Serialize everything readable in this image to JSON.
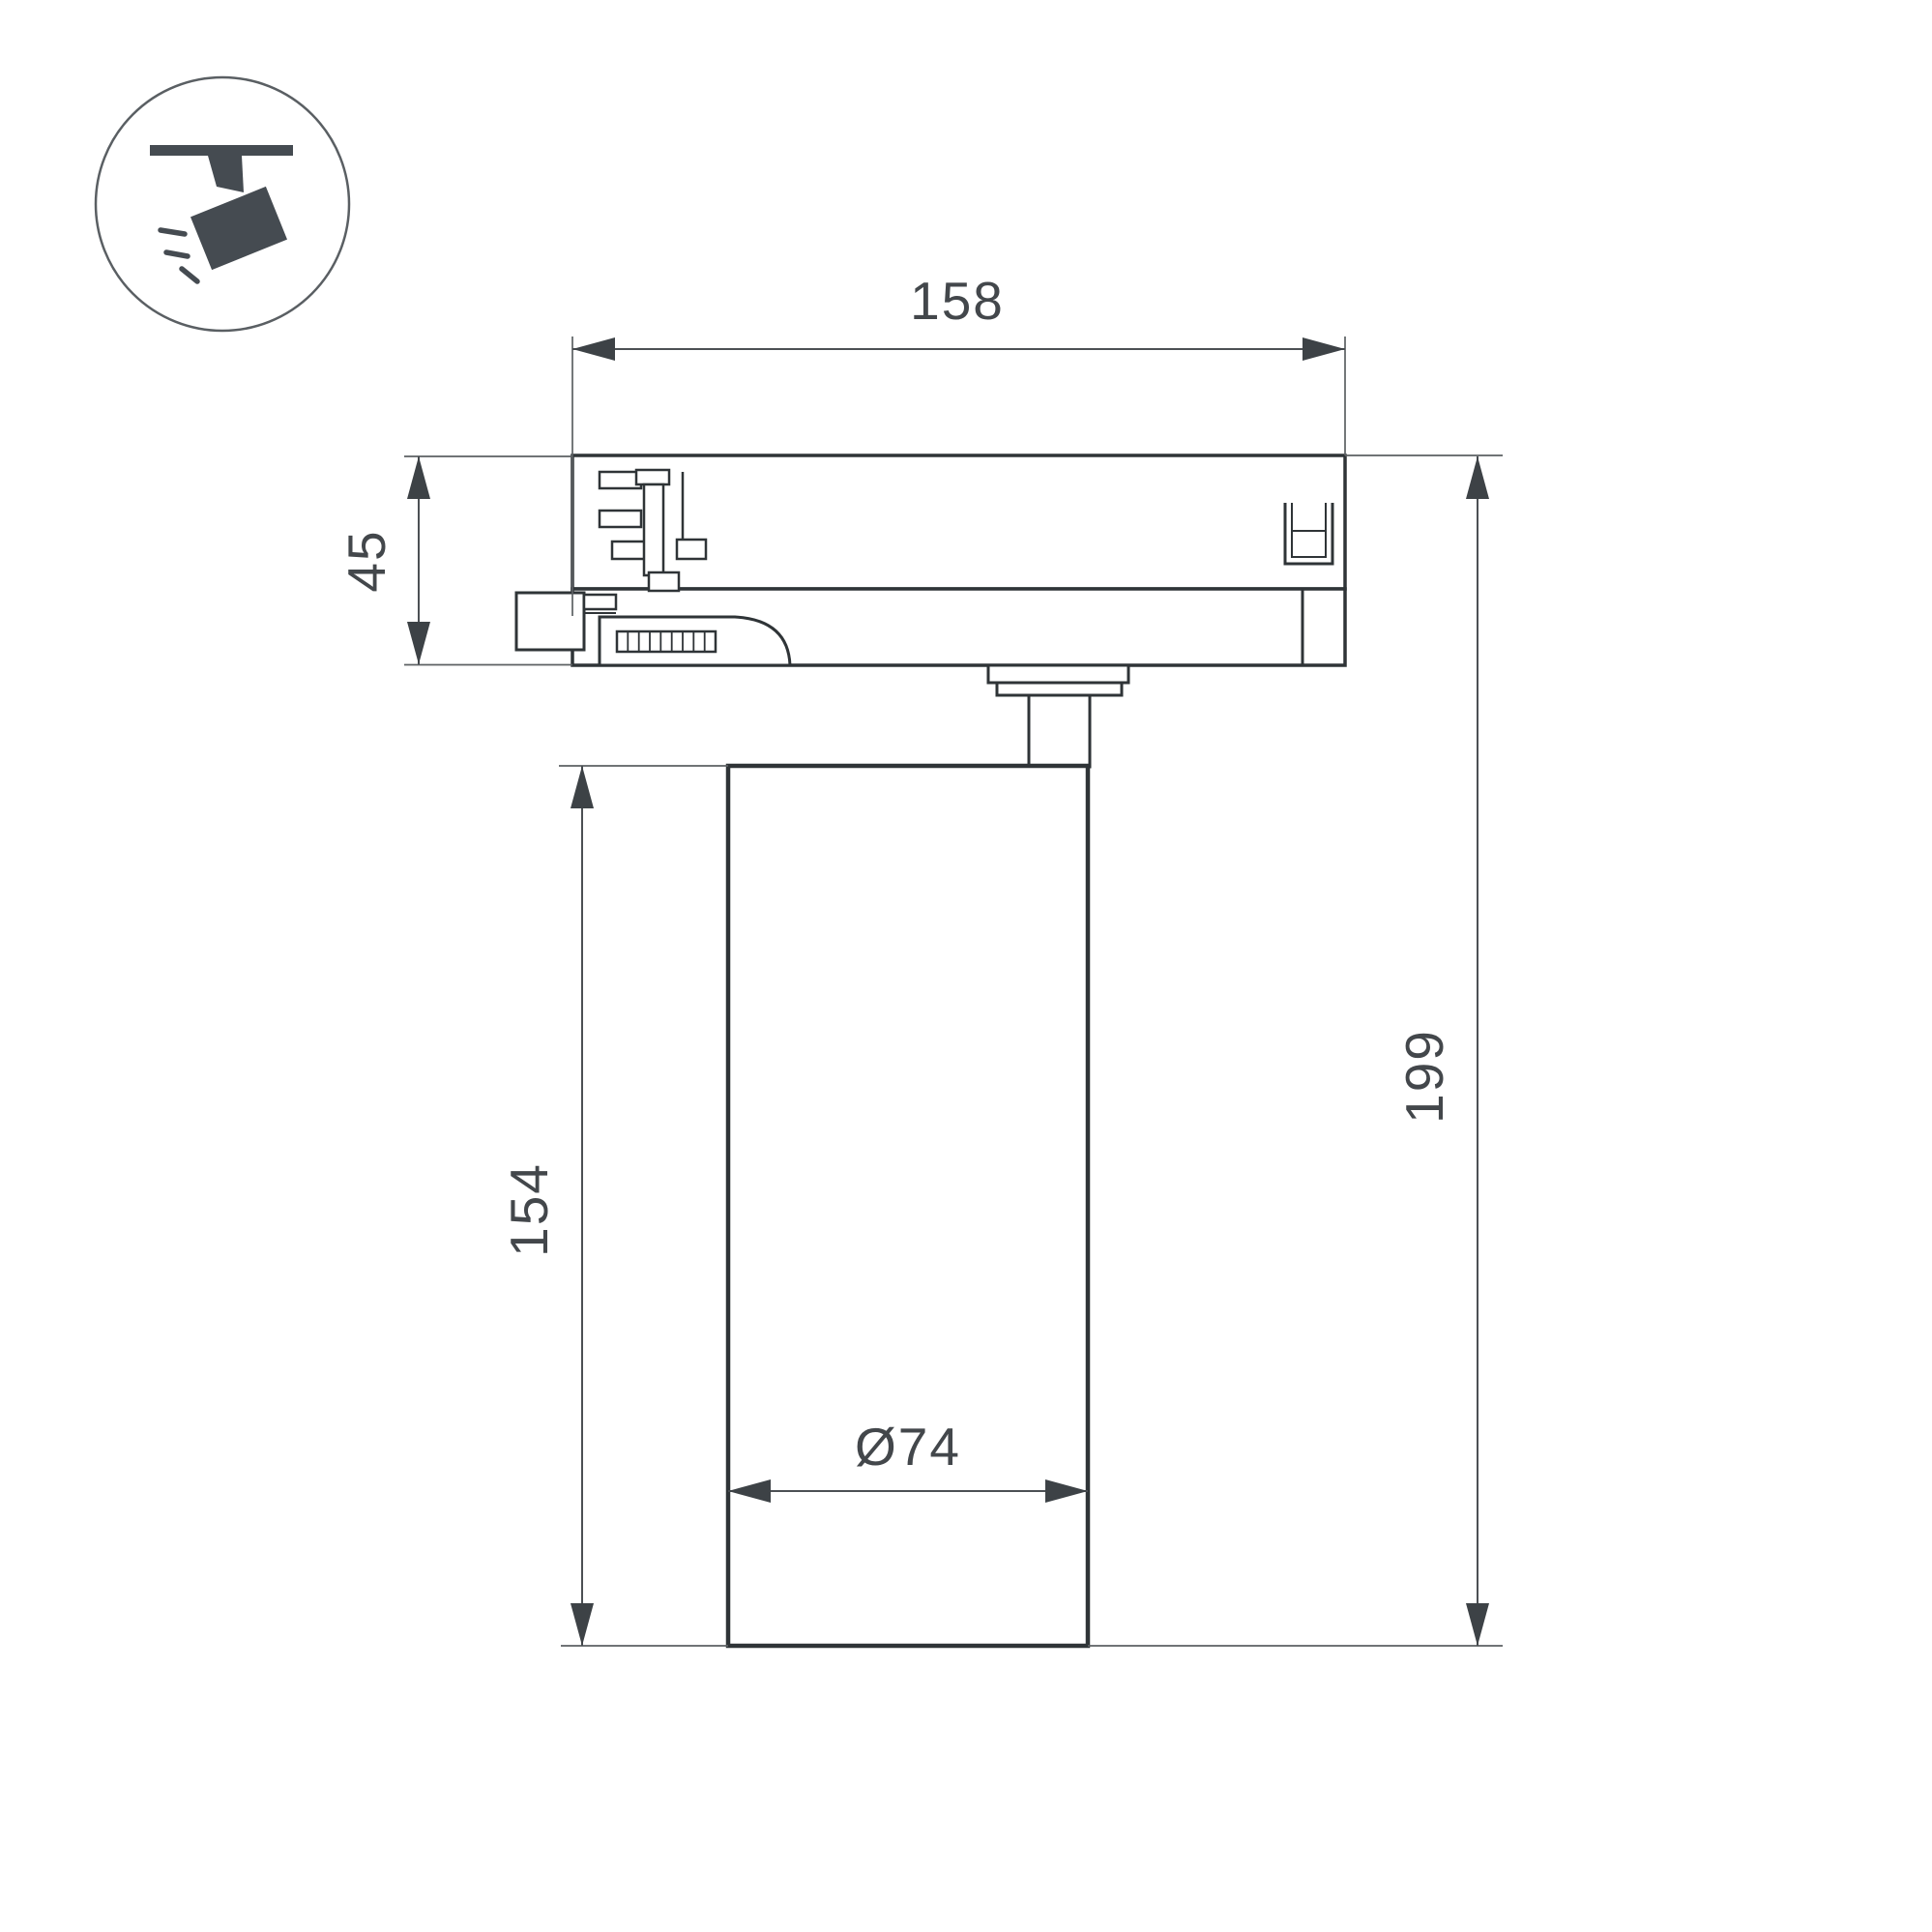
{
  "icon": {
    "name": "track-spotlight-icon",
    "depicts": "ceiling-track spotlight pictogram with light rays"
  },
  "dimensions": {
    "track_width_label": "158",
    "adapter_height_label": "45",
    "body_height_label": "154",
    "total_height_label": "199",
    "diameter_label": "Ø74"
  },
  "colors": {
    "drawing_line": "#2f3437",
    "dimension_line": "#5c6063",
    "arrowhead": "#3d4246",
    "dimension_text": "#43474b",
    "icon_fill": "#454b51",
    "background": "#ffffff"
  }
}
